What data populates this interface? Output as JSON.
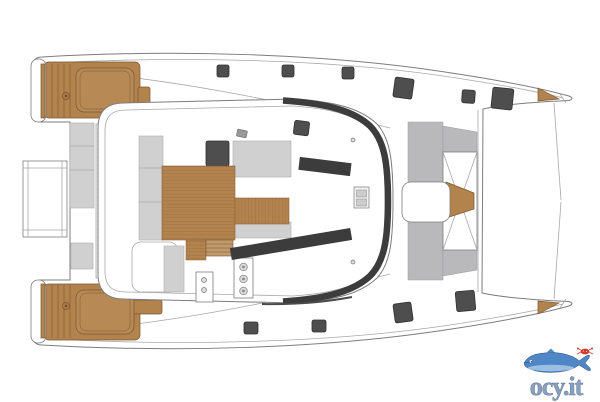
{
  "logo": {
    "text": "ocy.it",
    "icon": "fish-with-crab-icon"
  },
  "colors": {
    "background": "#ffffff",
    "line": "#7d7d7d",
    "line_light": "#a8a8a8",
    "teak": "#b3834e",
    "teak_dark": "#7a5632",
    "teak_light": "#c09a6a",
    "cushion_gray": "#d0d0d0",
    "panel_gray": "#b9b9bc",
    "hatch_dark": "#4e4e4e",
    "window_dark": "#3c3c3c",
    "logo_blue": "#4f86c6",
    "logo_blue_light": "#a8c8e8",
    "logo_text_color": "#8ba0bd",
    "logo_red": "#d93a2b"
  },
  "icons": {
    "deck_plan": "catamaran-deck-plan-icon",
    "fish": "fish-icon",
    "crab": "crab-icon"
  }
}
